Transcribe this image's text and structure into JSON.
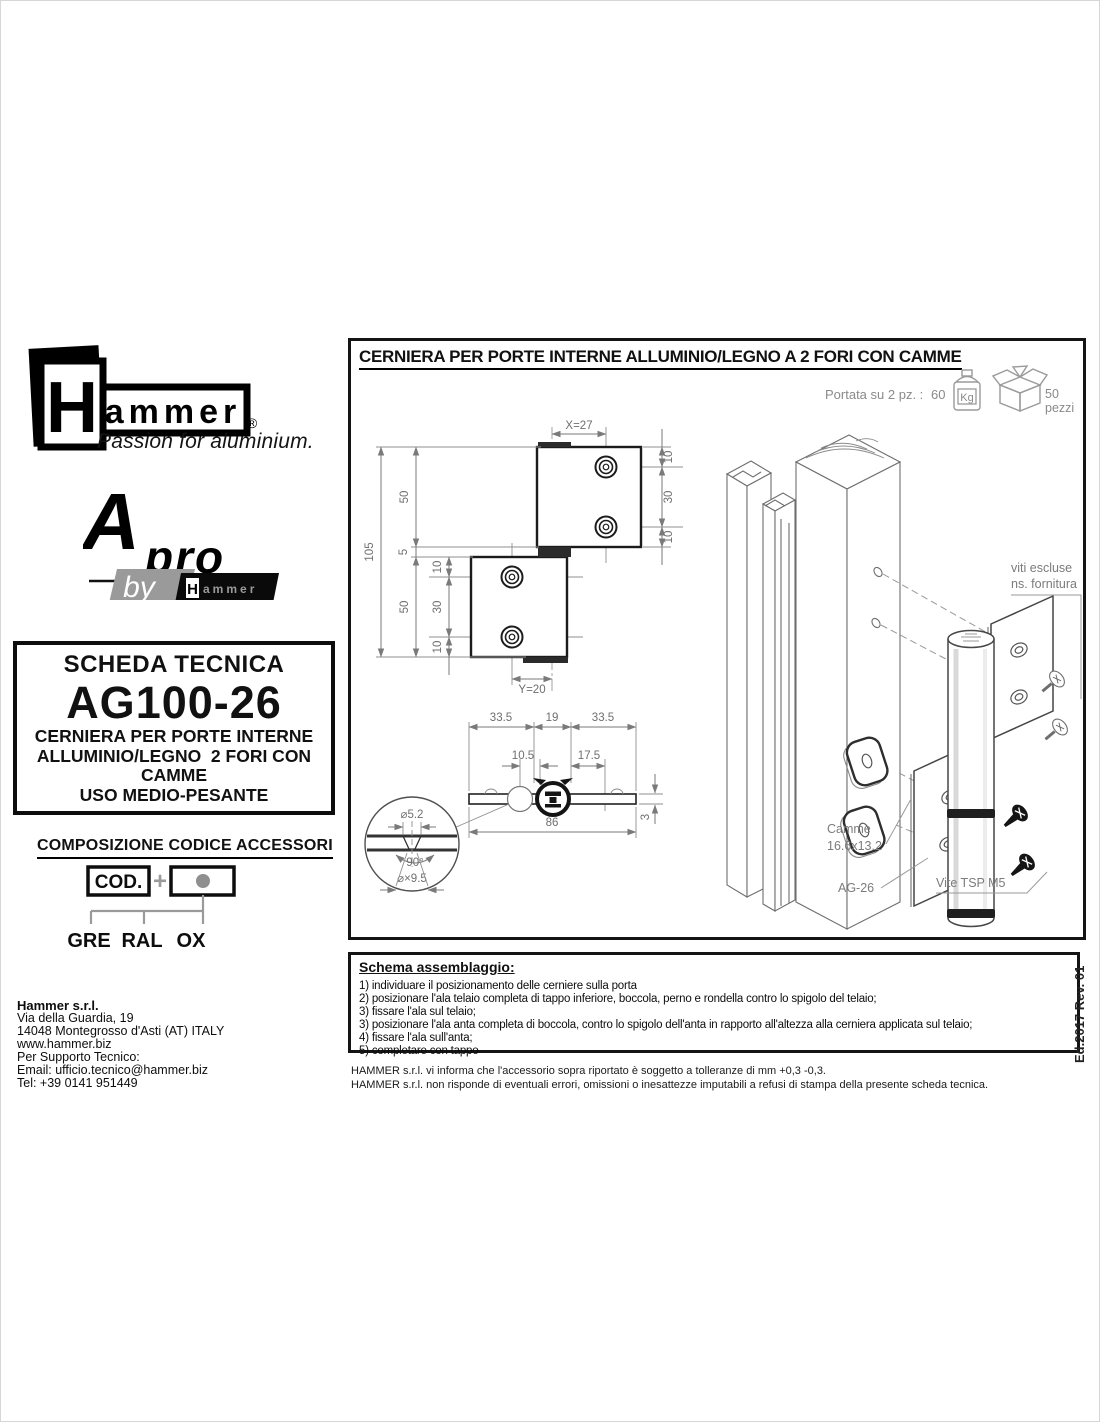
{
  "page": {
    "edition": "Ed.2017 Rev. 01"
  },
  "brand": {
    "h": "H",
    "ammer": "ammer",
    "reg": "®",
    "tagline": "Passion for aluminium.",
    "apro_a": "A",
    "apro_pro": "pro",
    "apro_by": "by",
    "apro_h": "H",
    "apro_ammer": "ammer"
  },
  "datasheet": {
    "heading": "SCHEDA TECNICA",
    "code": "AG100-26",
    "desc": [
      "CERNIERA PER PORTE INTERNE",
      "ALLUMINIO/LEGNO  2 FORI CON",
      "CAMME",
      "USO MEDIO-PESANTE"
    ]
  },
  "accessories": {
    "heading": "COMPOSIZIONE CODICE ACCESSORI",
    "cod": "COD.",
    "plus": "+",
    "options": [
      "GRE",
      "RAL",
      "OX"
    ]
  },
  "company": {
    "name": "Hammer s.r.l.",
    "lines": [
      "Via della Guardia, 19",
      "14048 Montegrosso d'Asti (AT) ITALY",
      "www.hammer.biz",
      "Per Supporto Tecnico:",
      "Email: ufficio.tecnico@hammer.biz",
      "Tel: +39 0141 951449"
    ]
  },
  "drawing": {
    "title": "CERNIERA PER PORTE INTERNE ALLUMINIO/LEGNO A 2 FORI CON CAMME",
    "capacity_label": "Portata su 2 pz. :",
    "capacity_value": "60",
    "capacity_unit": "Kg",
    "pack": "50 pezzi",
    "dims": {
      "x": "X=27",
      "y": "Y=20",
      "h_total": "105",
      "leaf": "50",
      "gap": "5",
      "edge": "10",
      "pitch": "30",
      "w_side": "33.5",
      "w_mid": "19",
      "off1": "10.5",
      "off2": "17.5",
      "w_total": "86",
      "thk": "3",
      "hole": "⌀5.2",
      "angle": "90°",
      "csk": "⌀×9.5"
    },
    "labels": {
      "screws1": "viti escluse",
      "screws2": "ns. fornitura",
      "cam1": "Camme",
      "cam2": "16.6x13.2",
      "hinge": "AG-26",
      "screw": "Vite TSP M5"
    }
  },
  "assembly": {
    "heading": "Schema assemblaggio:",
    "steps": [
      "1) individuare il posizionamento delle cerniere sulla porta",
      "2) posizionare l'ala telaio completa di tappo inferiore, boccola, perno e rondella contro lo spigolo del telaio;",
      "3) fissare l'ala sul telaio;",
      "3) posizionare l'ala anta completa di boccola, contro lo spigolo dell'anta in rapporto all'altezza alla cerniera applicata sul telaio;",
      "4) fissare l'ala sull'anta;",
      "5) completare con tappo"
    ]
  },
  "footnotes": [
    "HAMMER s.r.l. vi informa che l'accessorio sopra riportato è soggetto a tolleranze di mm +0,3 -0,3.",
    "HAMMER s.r.l. non risponde di eventuali errori, omissioni o inesattezze imputabili a refusi di stampa della presente scheda tecnica."
  ]
}
